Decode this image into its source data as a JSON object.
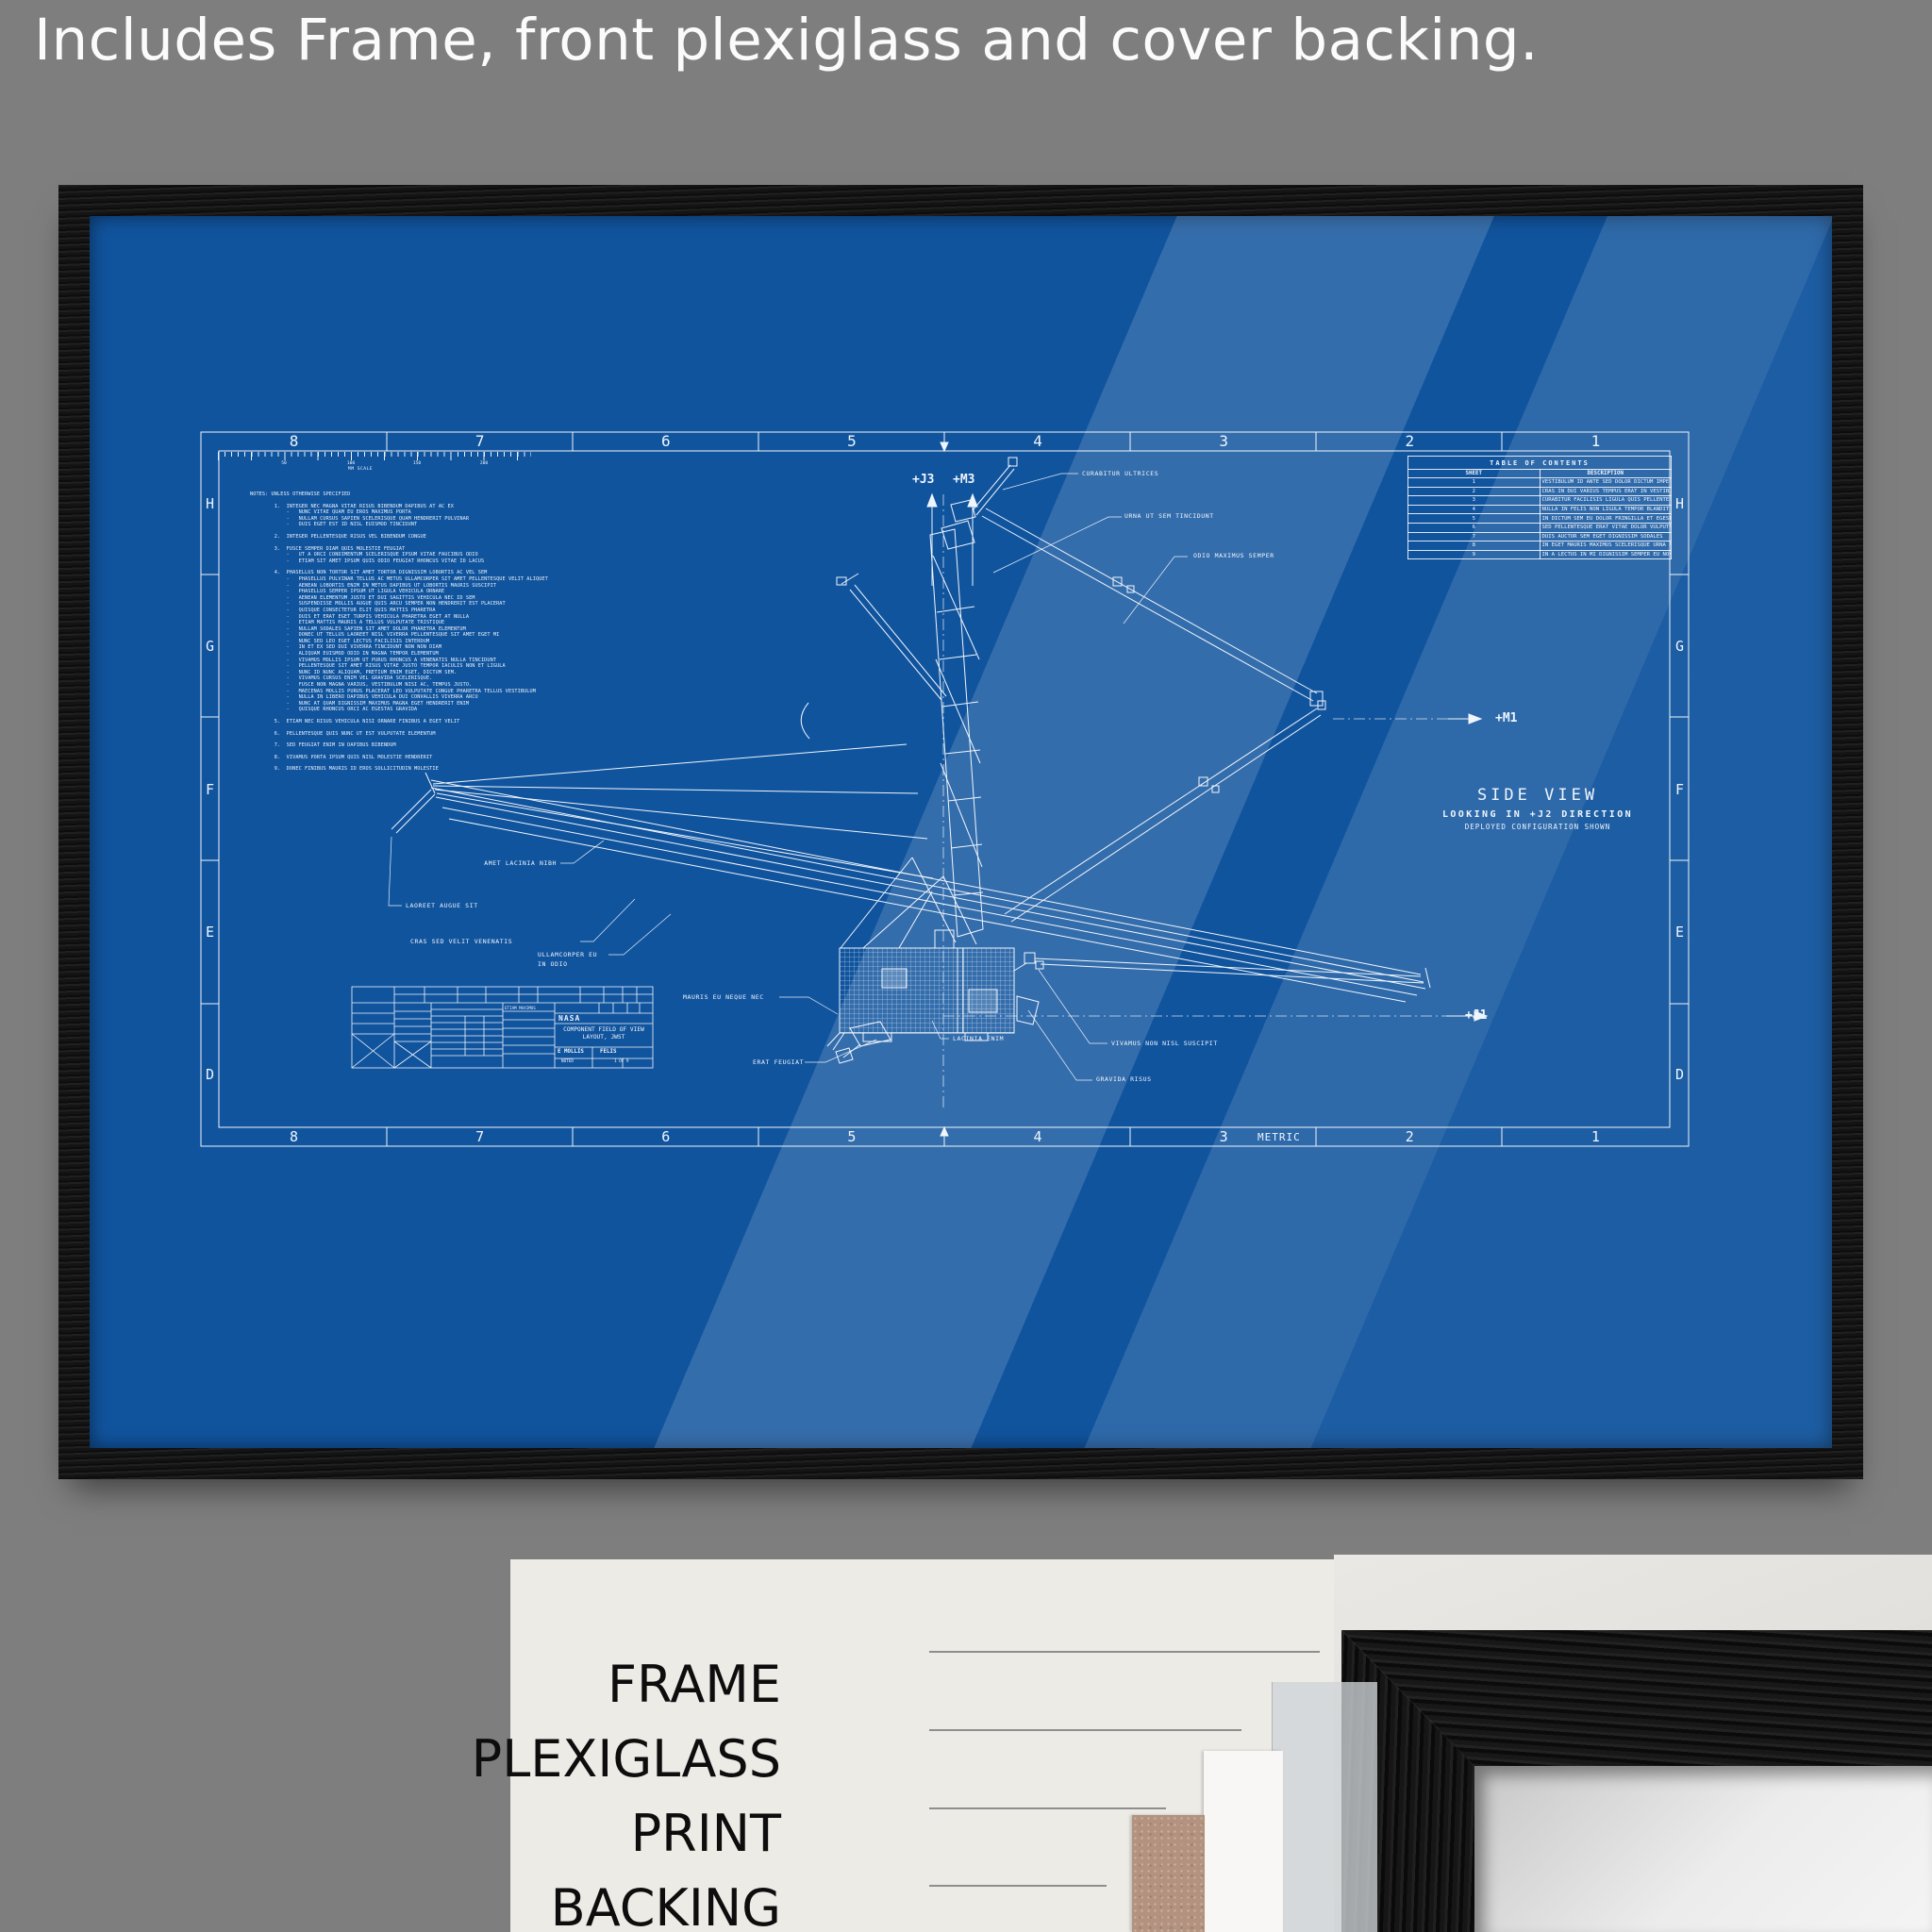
{
  "caption": "Includes Frame, front plexiglass and cover backing.",
  "colors": {
    "background_gray": "#7e7e7e",
    "blueprint_blue": "#11549e",
    "line_white": "#eef5fc",
    "frame_black": "#141414",
    "panel_white": "#edebe6",
    "backing_brown": "#b3937f"
  },
  "blueprint": {
    "zones_top": [
      "8",
      "7",
      "6",
      "5",
      "4",
      "3",
      "2",
      "1"
    ],
    "zones_bottom": [
      "8",
      "7",
      "6",
      "5",
      "4",
      "3",
      "2",
      "1"
    ],
    "zones_left": [
      "H",
      "G",
      "F",
      "E",
      "D"
    ],
    "zones_right": [
      "H",
      "G",
      "F",
      "E",
      "D"
    ],
    "metric_label": "METRIC",
    "scale_bar": {
      "label": "MM SCALE",
      "ticks": [
        "50",
        "100",
        "150",
        "200"
      ]
    },
    "notes_lines": [
      "NOTES: UNLESS OTHERWISE SPECIFIED",
      "",
      "        1.  INTEGER NEC MAGNA VITAE RISUS BIBENDUM DAPIBUS AT AC EX",
      "            -   NUNC VITAE QUAM EU EROS MAXIMUS PORTA",
      "            -   NULLAM CURSUS SAPIEN SCELERISQUE QUAM HENDRERIT PULVINAR",
      "            -   DUIS EGET EST ID NISL EUISMOD TINCIDUNT",
      "",
      "        2.  INTEGER PELLENTESQUE RISUS VEL BIBENDUM CONGUE",
      "",
      "        3.  FUSCE SEMPER DIAM QUIS MOLESTIE FEUGIAT",
      "            -   UT A ORCI CONDIMENTUM SCELERISQUE IPSUM VITAE FAUCIBUS ODIO",
      "            -   ETIAM SIT AMET IPSUM QUIS ODIO FEUGIAT RHONCUS VITAE ID LACUS",
      "",
      "        4.  PHASELLUS NON TORTOR SIT AMET TORTOR DIGNISSIM LOBORTIS AC VEL SEM",
      "            -   PHASELLUS PULVINAR TELLUS AC METUS ULLAMCORPER SIT AMET PELLENTESQUE VELIT ALIQUET",
      "            -   AENEAN LOBORTIS ENIM IN METUS DAPIBUS UT LOBORTIS MAURIS SUSCIPIT",
      "            -   PHASELLUS SEMPER IPSUM UT LIGULA VEHICULA ORNARE",
      "            -   AENEAN ELEMENTUM JUSTO ET DUI SAGITTIS VEHICULA NEC ID SEM",
      "            -   SUSPENDISSE MOLLIS AUGUE QUIS ARCU SEMPER NON HENDRERIT EST PLACERAT",
      "            -   QUISQUE CONSECTETUR ELIT QUIS MATTIS PHARETRA",
      "            -   DUIS ET ERAT EGET TURPIS VEHICULA PHARETRA EGET AT NULLA",
      "            -   ETIAM MATTIS MAURIS A TELLUS VULPUTATE TRISTIQUE",
      "            -   NULLAM SODALES SAPIEN SIT AMET DOLOR PHARETRA ELEMENTUM",
      "            -   DONEC UT TELLUS LAOREET NISL VIVERRA PELLENTESQUE SIT AMET EGET MI",
      "            -   NUNC SED LEO EGET LECTUS FACILISIS INTERDUM",
      "            -   IN ET EX SED DUI VIVERRA TINCIDUNT NON NON DIAM",
      "            -   ALIQUAM EUISMOD ODIO IN MAGNA TEMPOR ELEMENTUM",
      "            -   VIVAMUS MOLLIS IPSUM UT PURUS RHONCUS A VENENATIS NULLA TINCIDUNT",
      "            -   PELLENTESQUE SIT AMET RISUS VITAE JUSTO TEMPOR IACULIS NON ET LIGULA",
      "            -   NUNC ID NUNC ALIQUAM, PRETIUM ENIM EGET, DICTUM SEM.",
      "            -   VIVAMUS CURSUS ENIM VEL GRAVIDA SCELERISQUE.",
      "            -   FUSCE NON MAGNA VARIUS, VESTIBULUM NISI AC, TEMPUS JUSTO.",
      "            -   MAECENAS MOLLIS PURUS PLACERAT LEO VULPUTATE CONGUE PHARETRA TELLUS VESTIBULUM",
      "            -   NULLA IN LIBERO DAPIBUS VEHICULA DUI CONVALLIS VIVERRA ARCU",
      "            -   NUNC AT QUAM DIGNISSIM MAXIMUS MAGNA EGET HENDRERIT ENIM",
      "            -   QUISQUE RHONCUS ORCI AC EGESTAS GRAVIDA",
      "",
      "        5.  ETIAM NEC RISUS VEHICULA NISI ORNARE FINIBUS A EGET VELIT",
      "",
      "        6.  PELLENTESQUE QUIS NUNC UT EST VULPUTATE ELEMENTUM",
      "",
      "        7.  SED FEUGIAT ENIM IN DAPIBUS BIBENDUM",
      "",
      "        8.  VIVAMUS PORTA IPSUM QUIS NISL MOLESTIE HENDRERIT",
      "",
      "        9.  DONEC FINIBUS MAURIS ID EROS SOLLICITUDIN MOLESTIE"
    ],
    "toc": {
      "title": "TABLE OF CONTENTS",
      "header": [
        "SHEET",
        "DESCRIPTION"
      ],
      "rows": [
        {
          "sheet": "1",
          "desc": "VESTIBULUM ID ANTE SED DOLOR DICTUM IMPERDIET COMMODO"
        },
        {
          "sheet": "2",
          "desc": "CRAS IN DUI VARIUS TEMPUS ERAT IN VESTIBULUM EST"
        },
        {
          "sheet": "3",
          "desc": "CURABITUR FACILISIS LIGULA QUIS PELLENTESQUE"
        },
        {
          "sheet": "4",
          "desc": "NULLA IN FELIS NON LIGULA TEMPOR BLANDIT A EU EX"
        },
        {
          "sheet": "5",
          "desc": "IN DICTUM SEM EU DOLOR FRINGILLA ET EGESTAS LACUS"
        },
        {
          "sheet": "6",
          "desc": "SED PELLENTESQUE ERAT VITAE DOLOR VULPUTATE ULTRICES"
        },
        {
          "sheet": "7",
          "desc": "DUIS AUCTOR SEM EGET DIGNISSIM SODALES"
        },
        {
          "sheet": "8",
          "desc": "IN EGET MAURIS MAXIMUS SCELERISQUE URNA AT TINCIDUNT"
        },
        {
          "sheet": "9",
          "desc": "IN A LECTUS IN MI DIGNISSIM SEMPER EU NON SEM"
        }
      ]
    },
    "view": {
      "title": "SIDE VIEW",
      "subtitle": "LOOKING IN +J2 DIRECTION",
      "note": "DEPLOYED CONFIGURATION SHOWN"
    },
    "axis_labels": {
      "j3": "+J3",
      "m3": "+M3",
      "m1": "+M1",
      "j1": "+J1"
    },
    "callouts": {
      "curabitur": "CURABITUR ULTRICES",
      "urna": "URNA UT SEM TINCIDUNT",
      "odio": "ODIO MAXIMUS SEMPER",
      "amet": "AMET LACINIA NIBH",
      "laoreet": "LAOREET AUGUE SIT",
      "cras": "CRAS SED VELIT VENENATIS",
      "ullamcorper_l1": "ULLAMCORPER EU",
      "ullamcorper_l2": "IN ODIO",
      "mauris": "MAURIS EU NEQUE NEC",
      "erat": "ERAT FEU",
      "erat_full": "ERAT FEUGIAT",
      "lacinia": "LACINIA ENIM",
      "vivamus": "VIVAMUS NON NISL SUSCIPIT",
      "gravida": "GRAVIDA RISUS"
    },
    "title_block": {
      "agency": "NASA",
      "drawing_title_line1": "COMPONENT FIELD OF VIEW",
      "drawing_title_line2": "LAYOUT, JWST",
      "name1": "E MOLLIS",
      "name2": "FELIS",
      "scale_note": "NOTED",
      "sheet_note": "1 OF 9",
      "micro_label": "ETIAM MAXIMUS"
    }
  },
  "layers_panel": {
    "labels": [
      "FRAME",
      "PLEXIGLASS",
      "PRINT",
      "BACKING"
    ]
  }
}
